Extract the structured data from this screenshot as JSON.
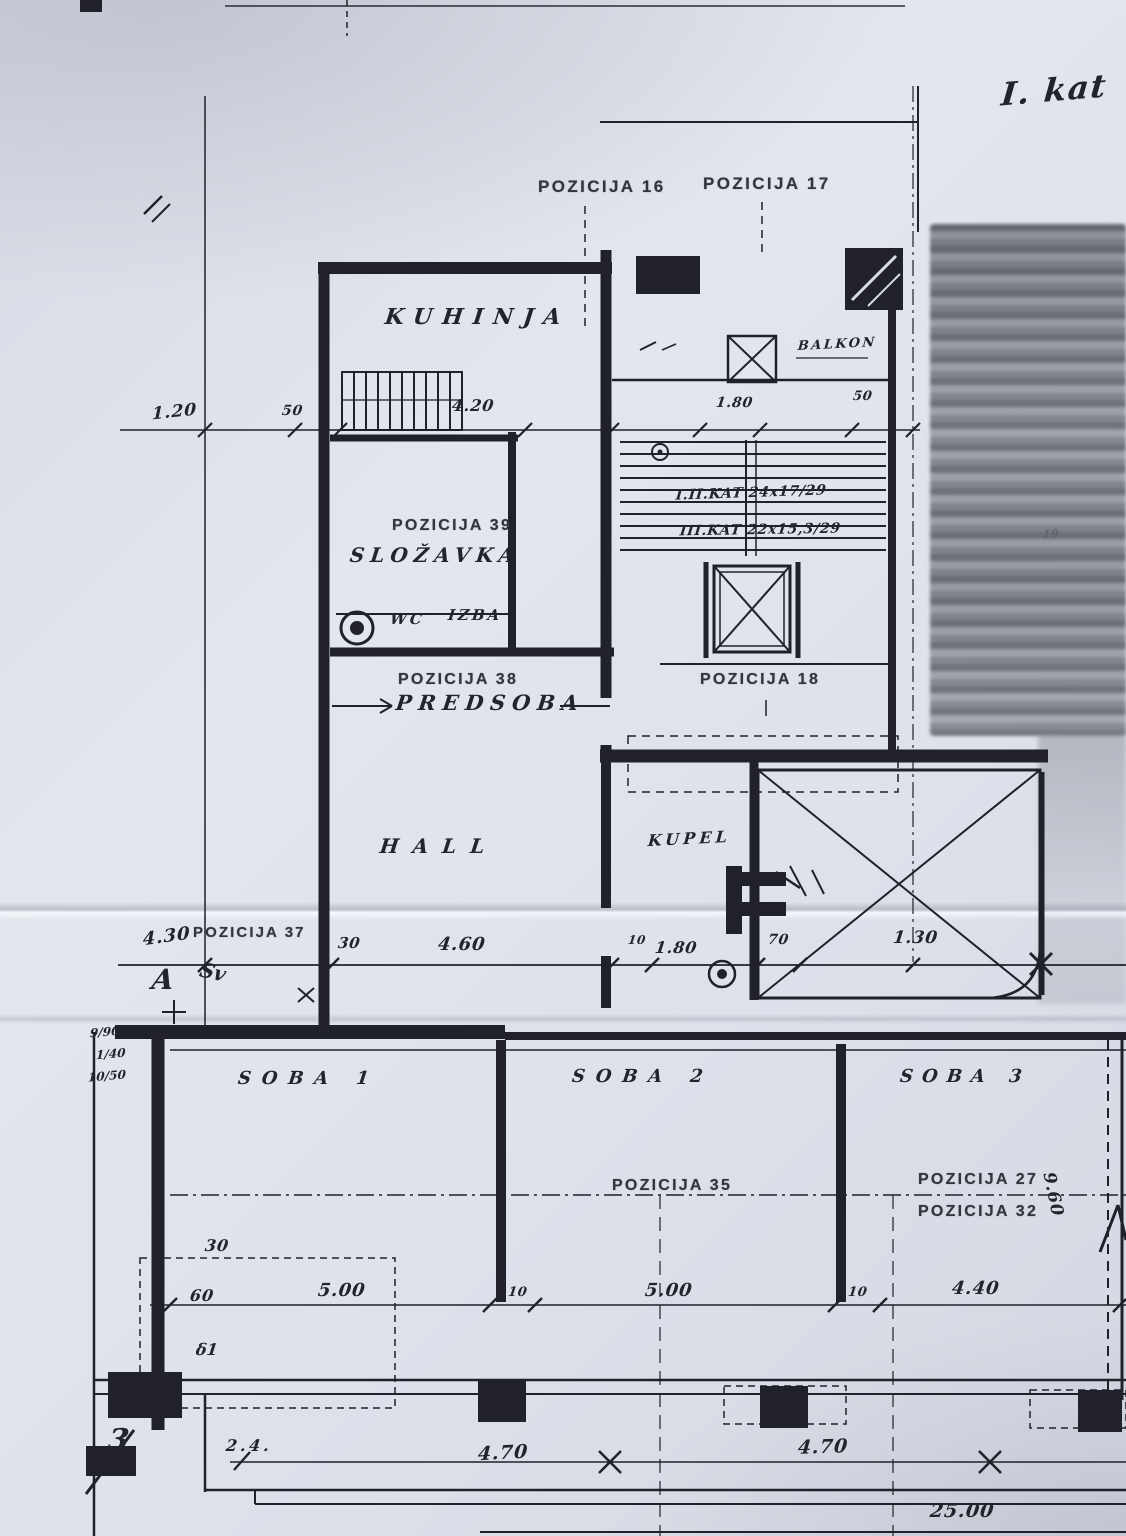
{
  "sheet": {
    "floor_note": "I. kat"
  },
  "positions": {
    "p16": "POZICIJA 16",
    "p17": "POZICIJA 17",
    "p18": "POZICIJA 18",
    "p27": "POZICIJA 27",
    "p32": "POZICIJA 32",
    "p35": "POZICIJA 35",
    "p37": "POZICIJA 37",
    "p38": "POZICIJA 38",
    "p39": "POZICIJA 39"
  },
  "rooms": {
    "kitchen": "KUHINJA",
    "pantry": "SLOŽAVKA",
    "wc": "WC",
    "izba": "IZBA",
    "entry": "PREDSOBA",
    "hall": "HALL",
    "bath": "KUPEL",
    "balcony": "BALKON",
    "room1": "SOBA 1",
    "room2": "SOBA 2",
    "room3": "SOBA 3"
  },
  "stair_notes": {
    "line1": "I.II.KAT 24x17/29",
    "line2": "III.KAT 22x15,3/29"
  },
  "dims": {
    "top_left": "1.20",
    "top_50a": "50",
    "kitchen_w": "4.20",
    "stair_w": "1.80",
    "top_50b": "50",
    "mid_left": "4.30",
    "mid_30": "30",
    "mid_main": "4.60",
    "mid_10": "10",
    "mid_180": "1.80",
    "mid_70": "70",
    "mid_130": "1.30",
    "low_30": "30",
    "low_60": "60",
    "low_5a": "5.00",
    "low_10a": "10",
    "low_5b": "5.00",
    "low_10b": "10",
    "low_44": "4.40",
    "bot_47a": "4.70",
    "bot_47b": "4.70",
    "bot_25": "25.00",
    "vert_96": "9.60"
  },
  "annotations": {
    "letter_a": "A",
    "squiggle_sv": "Sv",
    "delta1": "δ1",
    "page_no": "3",
    "scribble": "2.4.",
    "faint_19": "19",
    "beam_a": "9/90",
    "beam_b": "1/40",
    "beam_c": "10/50"
  }
}
